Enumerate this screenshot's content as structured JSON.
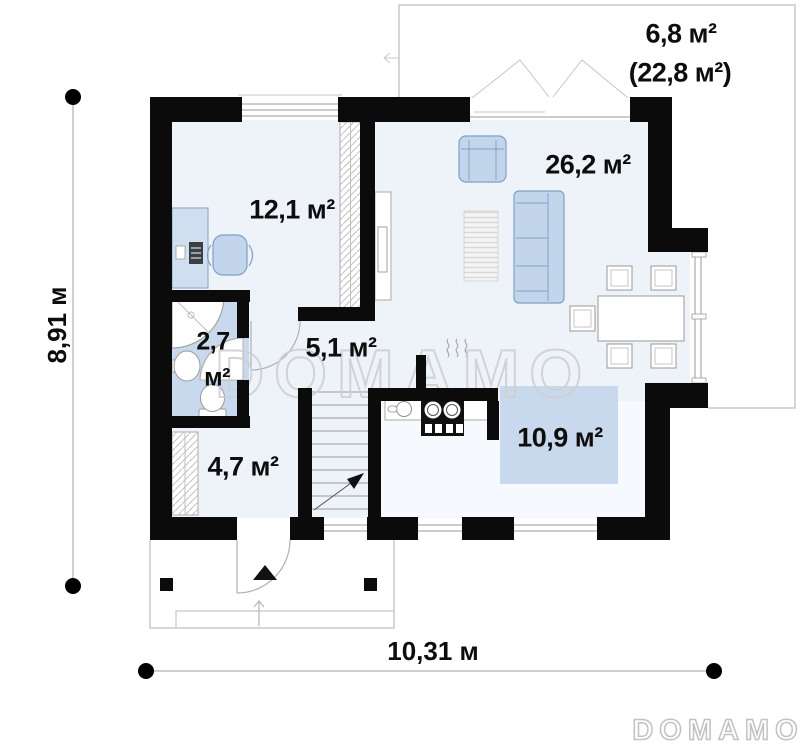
{
  "watermark": "DOMAMO",
  "logo": "DOMAMO",
  "dimensions": {
    "height": "8,91 м",
    "width": "10,31 м"
  },
  "rooms": {
    "terrace": {
      "area": "6,8 м²",
      "area_total": "(22,8 м²)"
    },
    "office": {
      "area": "12,1 м²"
    },
    "living": {
      "area": "26,2 м²"
    },
    "bathroom": {
      "area_value": "2,7",
      "area_unit": "м²"
    },
    "hall": {
      "area": "5,1 м²"
    },
    "entry": {
      "area": "4,7 м²"
    },
    "kitchen": {
      "area": "10,9 м²"
    }
  },
  "colors": {
    "wall": "#0b0b0b",
    "floor": "#eef2f9",
    "kitchen_floor": "#f6f9fd",
    "wet_zone": "#c9d9ed",
    "furniture_fill": "#c3d5ea",
    "furniture_stroke": "#7d9fc9",
    "outline_gray": "#c8c8c8",
    "watermark_gray": "#d0d0d0"
  }
}
